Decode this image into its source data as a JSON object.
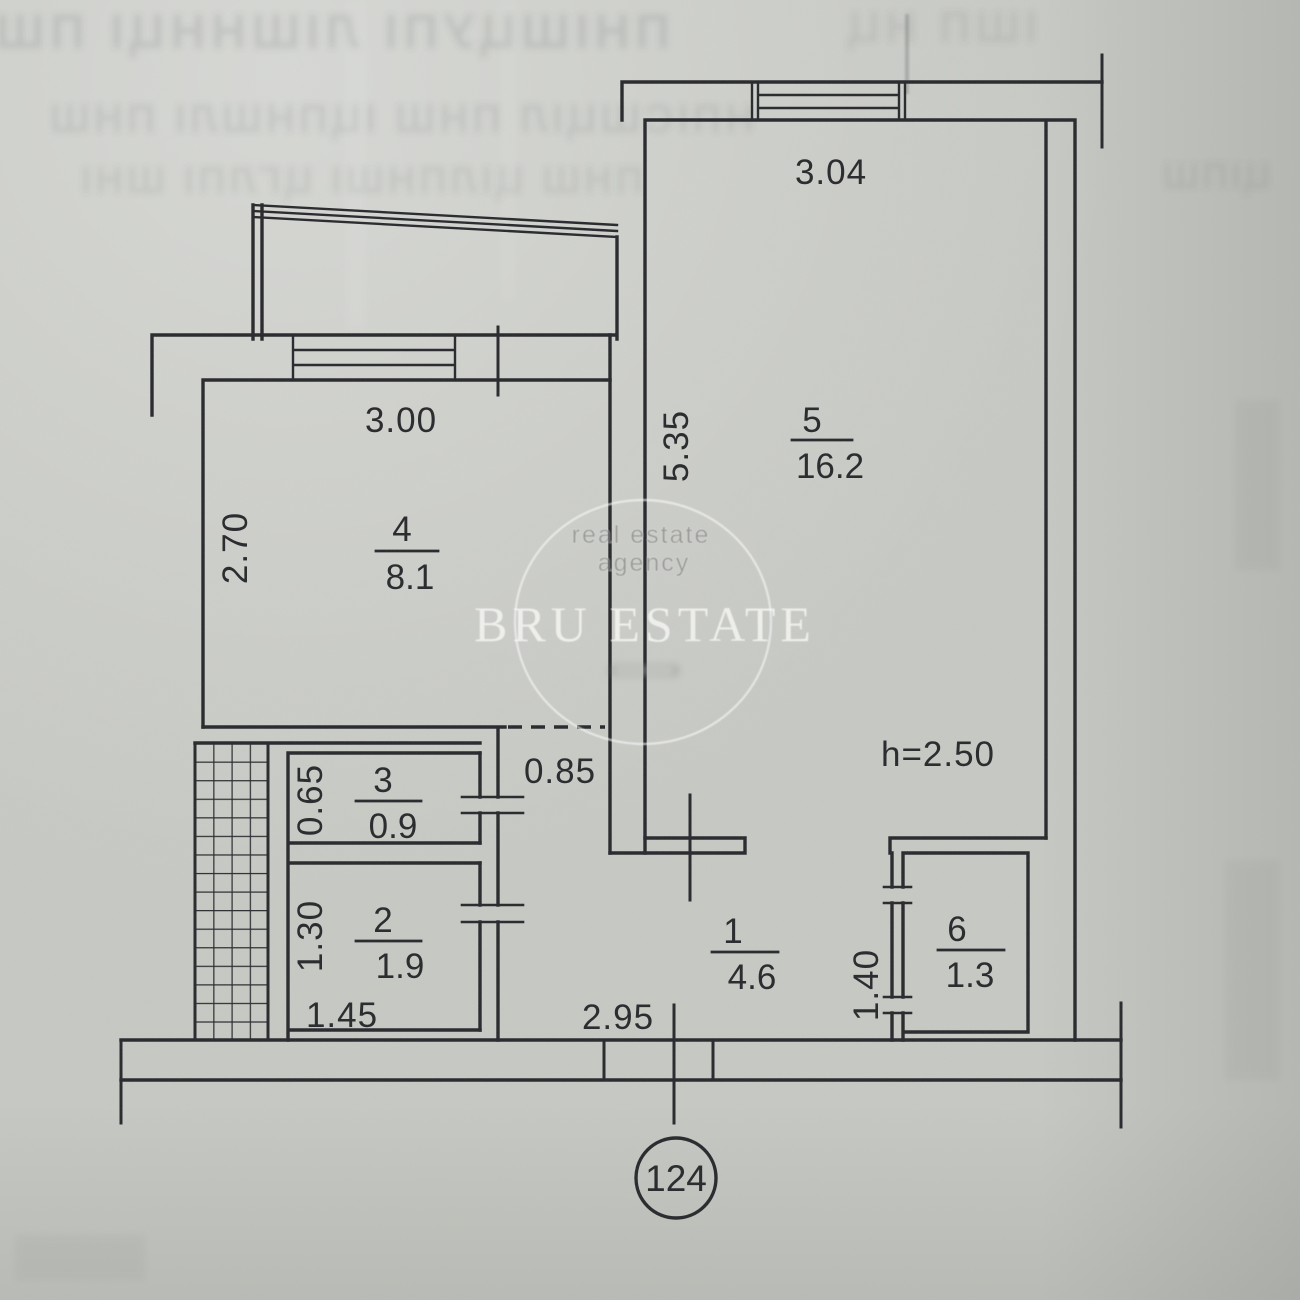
{
  "plan": {
    "apartment_number": "124",
    "ceiling_height": "h=2.50",
    "rooms": [
      {
        "id": "1",
        "area": "4.6"
      },
      {
        "id": "2",
        "area": "1.9"
      },
      {
        "id": "3",
        "area": "0.9"
      },
      {
        "id": "4",
        "area": "8.1"
      },
      {
        "id": "5",
        "area": "16.2"
      },
      {
        "id": "6",
        "area": "1.3"
      }
    ],
    "dimensions": {
      "room5_width": "3.04",
      "room4_width": "3.00",
      "room4_depth": "2.70",
      "room5_depth": "5.35",
      "opening_width": "0.85",
      "room3_depth": "0.65",
      "room2_depth": "1.30",
      "room2_width": "1.45",
      "hall_width": "2.95",
      "room6_depth": "1.40"
    }
  },
  "watermark": {
    "top_line": "real estate",
    "second_line": "agency",
    "brand": "BRU ESTATE"
  },
  "bleedthrough": {
    "row1": "ПНІШЦУПІ ЛІШННЦІ ПШ",
    "row1b": "ІШП НЦ",
    "row2": "НПІСШЦІЛ ПНШ ІЦПНШЛІ ПНШ",
    "row3": "ПНШ ЦІЛПНШІ ЦГЛПІ ШНІ",
    "right": "ЦІПШ"
  }
}
